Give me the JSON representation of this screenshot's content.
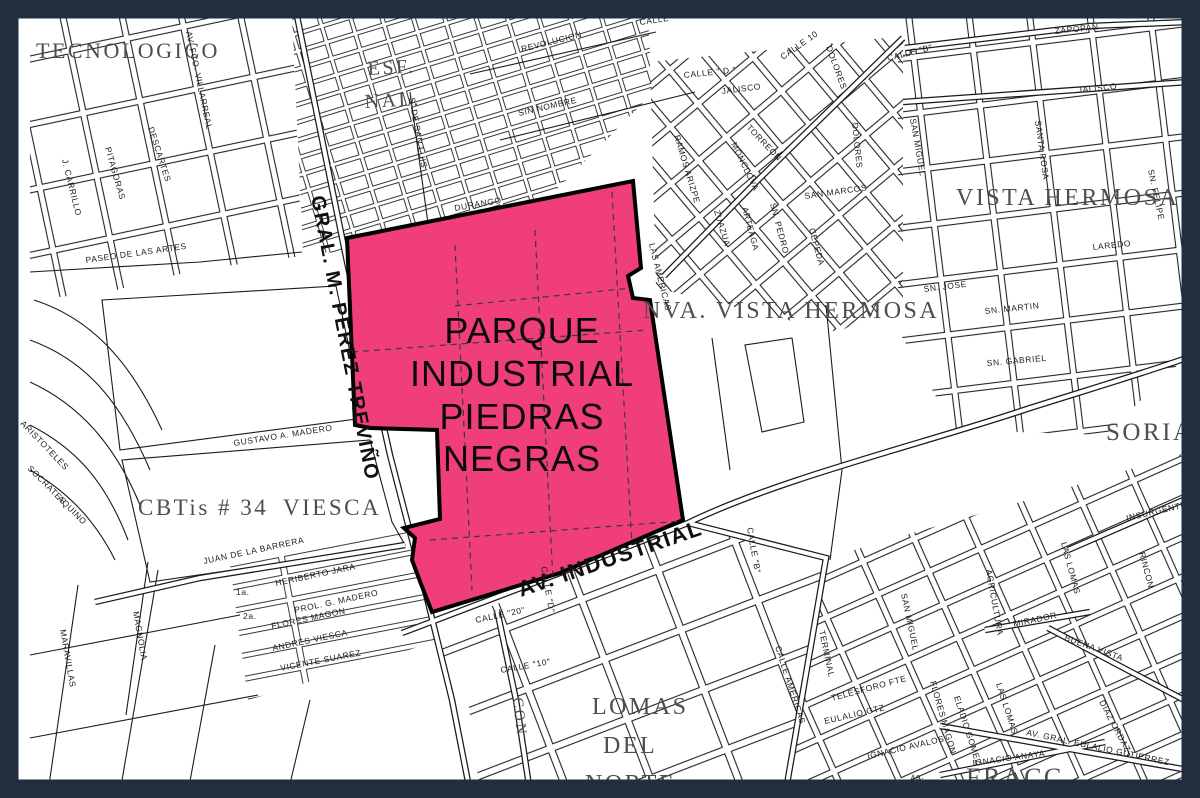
{
  "frame": {
    "color": "#202e40",
    "background": "#ffffff",
    "line_color": "#1c1c1c"
  },
  "park": {
    "label_lines": [
      "PARQUE",
      "INDUSTRIAL",
      "PIEDRAS",
      "NEGRAS"
    ],
    "fill": "#f03e7c",
    "outline": "#000000"
  },
  "area_labels": [
    {
      "id": "tecnologico",
      "text": "TECNOLOGICO"
    },
    {
      "id": "esf",
      "text": "ESF."
    },
    {
      "id": "nal",
      "text": "NAL."
    },
    {
      "id": "vista-hermosa",
      "text": "VISTA HERMOSA"
    },
    {
      "id": "nva-vista-hermosa",
      "text": "NVA. VISTA HERMOSA"
    },
    {
      "id": "cbtis-34",
      "text": "CBTis # 34"
    },
    {
      "id": "viesca",
      "text": "VIESCA"
    },
    {
      "id": "soriana",
      "text": "SORIANA"
    },
    {
      "id": "lomas",
      "text": "LOMAS"
    },
    {
      "id": "del",
      "text": "DEL"
    },
    {
      "id": "norte",
      "text": "NORTE"
    },
    {
      "id": "fracc",
      "text": "FRACC"
    },
    {
      "id": "con",
      "text": "CON"
    }
  ],
  "street_labels": [
    {
      "id": "av-fco-villarreal",
      "text": "AV. FCO. VILLARREAL"
    },
    {
      "id": "descartes",
      "text": "DESCARTES"
    },
    {
      "id": "pitagoras",
      "text": "PITAGORAS"
    },
    {
      "id": "j-carrillo",
      "text": "J. CARRILLO"
    },
    {
      "id": "paseo-de-las-artes",
      "text": "PASEO DE LAS ARTES"
    },
    {
      "id": "aristoteles",
      "text": "ARISTOTELES"
    },
    {
      "id": "socrates",
      "text": "SOCRATES"
    },
    {
      "id": "aquino",
      "text": "AQUINO"
    },
    {
      "id": "revolucion",
      "text": "REVOLUCION"
    },
    {
      "id": "sin-nombre",
      "text": "SIN NOMBRE"
    },
    {
      "id": "s-de-san-luis",
      "text": "S. DE SAN LUIS"
    },
    {
      "id": "durango",
      "text": "DURANGO"
    },
    {
      "id": "gral-m-perez-trevino",
      "text": "GRAL. M. PEREZ TREVIÑO"
    },
    {
      "id": "av-industrial",
      "text": "AV. INDUSTRIAL"
    },
    {
      "id": "calle",
      "text": "CALLE"
    },
    {
      "id": "calle-d-top",
      "text": "CALLE \" D \""
    },
    {
      "id": "calle-10-top",
      "text": "CALLE 10"
    },
    {
      "id": "dolores-1",
      "text": "DOLORES"
    },
    {
      "id": "calle-b-top",
      "text": "CALLE \"B\""
    },
    {
      "id": "jalisco-w",
      "text": "JALISCO"
    },
    {
      "id": "torreon",
      "text": "TORREON"
    },
    {
      "id": "monclova",
      "text": "MONCLOVA"
    },
    {
      "id": "ramos-arizpe",
      "text": "RAMOS ARIZPE"
    },
    {
      "id": "zuazua",
      "text": "ZUAZUA"
    },
    {
      "id": "arteaga",
      "text": "ARTEAGA"
    },
    {
      "id": "sn-pedro",
      "text": "SN. PEDRO"
    },
    {
      "id": "cepeda",
      "text": "CEPEDA"
    },
    {
      "id": "san-marcos",
      "text": "SAN MARCOS"
    },
    {
      "id": "dolores-2",
      "text": "DOLORES"
    },
    {
      "id": "san-miguel-ne",
      "text": "SAN MIGUEL"
    },
    {
      "id": "zapopan",
      "text": "ZAPOPAN"
    },
    {
      "id": "jalisco-e",
      "text": "JALISCO"
    },
    {
      "id": "santa-rosa",
      "text": "SANTA ROSA"
    },
    {
      "id": "sn-felipe",
      "text": "SN. FELIPE"
    },
    {
      "id": "laredo",
      "text": "LAREDO"
    },
    {
      "id": "sn-jose",
      "text": "SN. JOSE"
    },
    {
      "id": "sn-martin",
      "text": "SN. MARTIN"
    },
    {
      "id": "sn-gabriel",
      "text": "SN. GABRIEL"
    },
    {
      "id": "las-americas",
      "text": "LAS AMERICAS"
    },
    {
      "id": "calle-d-v",
      "text": "CALLE \"D\""
    },
    {
      "id": "calle-20",
      "text": "CALLE \"20\""
    },
    {
      "id": "calle-10",
      "text": "CALLE \"10\""
    },
    {
      "id": "calle-b-v",
      "text": "CALLE \"B\""
    },
    {
      "id": "terminal",
      "text": "TERMINAL"
    },
    {
      "id": "gustavo-a-madero",
      "text": "GUSTAVO A. MADERO"
    },
    {
      "id": "juan-de-la-barrera",
      "text": "JUAN DE LA BARRERA"
    },
    {
      "id": "heriberto-jara",
      "text": "HERIBERTO JARA"
    },
    {
      "id": "prol-g-madero",
      "text": "PROL. G. MADERO"
    },
    {
      "id": "flores-magon",
      "text": "FLORES MAGON"
    },
    {
      "id": "andres-viesca",
      "text": "ANDRES VIESCA"
    },
    {
      "id": "vicente-suarez",
      "text": "VICENTE SUAREZ"
    },
    {
      "id": "calle-1a",
      "text": "1a."
    },
    {
      "id": "calle-2a",
      "text": "2a."
    },
    {
      "id": "magnolia",
      "text": "MAGNOLIA"
    },
    {
      "id": "maravillas",
      "text": "MARAVILLAS"
    },
    {
      "id": "calle-americas",
      "text": "CALLE AMERICAS"
    },
    {
      "id": "san-miguel-se",
      "text": "SAN MIGUEL"
    },
    {
      "id": "agricultura",
      "text": "AGRICULTURA"
    },
    {
      "id": "las-lomas-1",
      "text": "LAS LOMAS"
    },
    {
      "id": "las-lomas-2",
      "text": "LAS LOMAS"
    },
    {
      "id": "rincon",
      "text": "RINCON"
    },
    {
      "id": "insurgentes",
      "text": "INSURGENTES"
    },
    {
      "id": "mirador",
      "text": "MIRADOR"
    },
    {
      "id": "buena-vista",
      "text": "BUENA VISTA"
    },
    {
      "id": "diaz-ordaz",
      "text": "DIAZ ORDAZ"
    },
    {
      "id": "av-gral-eulalio-gutierrez",
      "text": "AV. GRAL. EULALIO GUTIERREZ"
    },
    {
      "id": "ignacio-anaya",
      "text": "IGNACIO ANAYA"
    },
    {
      "id": "telesforo",
      "text": "TELESFORO FTE"
    },
    {
      "id": "eulalio-gtz",
      "text": "EULALIO GTZ"
    },
    {
      "id": "ignacio-avalos",
      "text": "IGNACIO AVALOS"
    },
    {
      "id": "flores-magon-se",
      "text": "FLORES MAGON"
    },
    {
      "id": "eladio-gomez",
      "text": "ELADIO GOMEZ"
    },
    {
      "id": "calle-4a",
      "text": "4a."
    }
  ]
}
